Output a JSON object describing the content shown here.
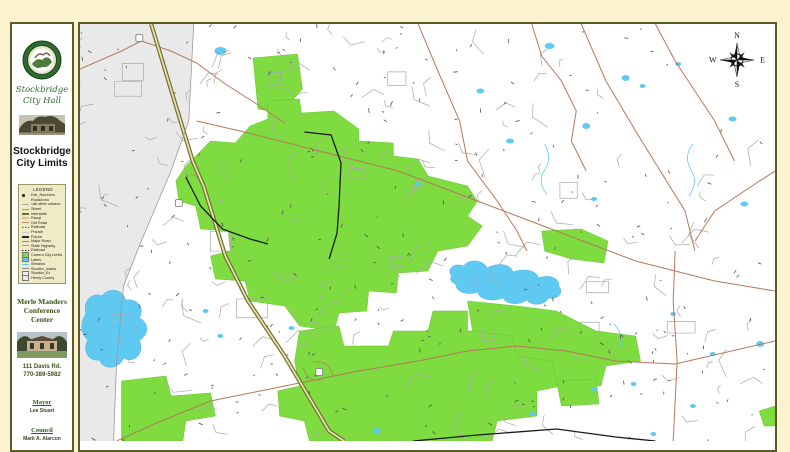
{
  "sidebar": {
    "hall_title": [
      "Stockbridge",
      "City Hall"
    ],
    "map_title": [
      "Stockbridge",
      "City Limits"
    ],
    "legend": {
      "title": "LEGEND",
      "items": [
        {
          "label": "Exit_Numbers",
          "sym": "dot",
          "color": "#222222"
        },
        {
          "label": "RoadAnno",
          "sym": "none",
          "color": "#666666"
        },
        {
          "label": "<all other values>",
          "sym": "line",
          "color": "#aaaaaa"
        },
        {
          "label": "Street",
          "sym": "line",
          "color": "#999999"
        },
        {
          "label": "Interstate",
          "sym": "thick",
          "color": "#6F6F2A"
        },
        {
          "label": "Ramp",
          "sym": "thick",
          "color": "#C9C99A"
        },
        {
          "label": "Old Road",
          "sym": "line",
          "color": "#B89070"
        },
        {
          "label": "Railroad",
          "sym": "dash",
          "color": "#555555"
        },
        {
          "label": "Private",
          "sym": "line",
          "color": "#C9C9C9"
        },
        {
          "label": "Future",
          "sym": "thick",
          "color": "#222222"
        },
        {
          "label": "Major Road",
          "sym": "line",
          "color": "#B5785A"
        },
        {
          "label": "State Highway",
          "sym": "line",
          "color": "#C08C6C"
        },
        {
          "label": "Railroad",
          "sym": "dash",
          "color": "#333333"
        },
        {
          "label": "Current City Limits",
          "sym": "swatch",
          "color": "#7EDC41"
        },
        {
          "label": "Lakes",
          "sym": "swatch",
          "color": "#5FC9F2"
        },
        {
          "label": "Streams",
          "sym": "line",
          "color": "#5FC9F2"
        },
        {
          "label": "Stockbr_marks",
          "sym": "line",
          "color": "#8888AA"
        },
        {
          "label": "Stockbr_Ex",
          "sym": "swatch",
          "color": "#EFEFEF"
        },
        {
          "label": "Henry County",
          "sym": "swatch",
          "color": "#E9E9E9"
        }
      ]
    },
    "venue": {
      "name": [
        "Merle Manders",
        "Conference Center"
      ],
      "address": "111 Davis Rd.",
      "phone": "770-389-5982"
    },
    "officials": [
      {
        "role": "Mayor",
        "name": "Lee Stuart"
      },
      {
        "role": "Council",
        "name": "Mark A. Alarcon"
      }
    ]
  },
  "compass": {
    "north": "N",
    "east": "E",
    "south": "S",
    "west": "W"
  },
  "map": {
    "colors": {
      "page_bg": "#FBF2D0",
      "frame": "#5B5B26",
      "county_fill": "#E9E9E9",
      "city_green": "#7EDC41",
      "water": "#5FC9F2",
      "road_minor": "#A8A8A8",
      "road_tick": "#4F4F4F",
      "road_major": "#B5785A",
      "interstate_casing": "#6F6F2A",
      "interstate_fill": "#E6E2B4",
      "railroad": "#1A1A1A",
      "boundary": "#999999"
    },
    "layers": {
      "county": "M0,0 L115,0 L110,97 L92,147 L62,217 L44,262 L37,337 L34,417 L0,417 Z",
      "boundary": "M115,0 L110,97 L92,147 L62,217 L44,262 L37,337 L34,417",
      "city_polygons": [
        "M175,34 L220,30 L225,65 L204,89 L180,85 Z",
        "M107,142 L132,117 L157,119 L172,102 L190,95 L190,77 L222,75 L224,89 L257,87 L282,105 L282,117 L317,119 L317,132 L342,135 L352,152 L392,162 L402,177 L392,192 L407,202 L392,222 L362,227 L352,247 L322,249 L320,269 L292,267 L290,287 L262,289 L257,307 L222,302 L207,282 L172,277 L167,257 L137,255 L132,232 L152,227 L150,207 L122,205 L117,182 L100,177 L97,157 Z",
        "M222,307 L262,302 L267,322 L312,322 L317,307 L352,307 L357,287 L392,287 L392,307 L442,307 L452,327 L482,332 L487,362 L462,367 L462,392 L422,397 L417,417 L232,417 L227,397 L202,392 L200,367 L222,362 L217,337 Z",
        "M392,277 L442,282 L482,287 L522,307 L562,312 L567,337 L532,342 L527,362 L482,357 L477,337 L442,332 L437,312 L397,307 Z",
        "M467,207 L507,205 L534,217 L530,239 L497,235 L470,227 Z",
        "M42,357 L87,352 L92,372 L132,369 L137,392 L107,397 L104,417 L42,417 Z",
        "M687,387 L703,382 L703,402 L692,402 Z",
        "M482,357 L522,355 L525,380 L487,382 Z"
      ],
      "lakes": [
        "M6,290 C2,275 14,268 22,272 C30,262 44,266 46,276 C58,274 66,284 60,294 C70,298 70,312 60,316 C66,330 54,340 44,334 C40,346 22,346 20,336 C8,338 2,326 8,316 C0,310 0,298 6,290 Z",
        "M376,252 C370,246 378,238 388,242 C394,234 408,236 412,244 C422,238 436,240 438,248 C448,244 462,246 464,254 C474,250 486,254 484,262 C490,268 484,276 474,274 C470,282 456,282 452,276 C444,282 430,280 428,274 C418,278 404,276 402,268 C392,272 380,268 380,260 C374,258 374,254 376,252 Z"
      ],
      "ponds": [
        [
          142,
          27,
          6,
          4
        ],
        [
          405,
          67,
          4,
          2.5
        ],
        [
          435,
          117,
          4,
          2.5
        ],
        [
          475,
          22,
          5,
          3
        ],
        [
          552,
          54,
          4,
          3
        ],
        [
          569,
          62,
          3,
          2
        ],
        [
          512,
          102,
          4,
          3
        ],
        [
          605,
          40,
          3,
          2
        ],
        [
          660,
          95,
          4,
          2.5
        ],
        [
          342,
          160,
          3,
          2
        ],
        [
          300,
          407,
          4,
          3
        ],
        [
          127,
          287,
          3,
          2
        ],
        [
          142,
          312,
          3,
          2
        ],
        [
          214,
          304,
          3,
          2
        ],
        [
          688,
          320,
          4,
          3
        ],
        [
          640,
          330,
          3,
          2
        ],
        [
          600,
          290,
          3,
          2
        ],
        [
          560,
          360,
          3,
          2
        ],
        [
          520,
          365,
          3,
          2
        ],
        [
          620,
          382,
          3,
          2
        ],
        [
          580,
          410,
          3,
          2
        ],
        [
          458,
          390,
          3,
          2
        ],
        [
          672,
          180,
          4,
          2.5
        ],
        [
          520,
          175,
          3,
          2
        ]
      ],
      "streams": [
        "M470,120 q8,14 0,26 q-8,12 2,24",
        "M620,120 q-10,12 -2,26 q8,12 -2,26",
        "M540,300 q10,10 6,24"
      ],
      "roads_major": [
        "M0,45 L42,27 L62,17 L92,27 L118,39 L147,60 L174,77 L207,99",
        "M342,0 L362,47 L384,97 L392,137 L422,177 L442,207 L452,227",
        "M507,0 L532,57 L562,107 L587,147 L612,187 L622,227",
        "M582,0 L602,37 L622,67 L642,97 L662,137",
        "M602,227 L600,277 L604,337 L600,417",
        "M37,417 L82,397 L132,377 L182,367 L232,357 L282,347 L342,337 L392,327 L442,322 L492,327 L542,337 L602,340 L703,317",
        "M118,97 L162,107 L202,117 L242,127 L282,137 L322,147 L362,162 L402,177 L442,192 L482,207 L522,222 L562,237 L602,247 L642,257 L703,267",
        "M457,0 L467,32 L487,57 L502,87 L497,117 L512,147",
        "M703,147 L672,167 L642,187 L622,217"
      ],
      "interstate": "M72,0 L94,72 L114,137 L125,162 L147,232 L170,277 L207,332 L252,407 L267,417",
      "interstate_ramps": [
        "M112,150 q14,4 16,20",
        "M236,338 q16,-2 20,14",
        "M244,356 q-14,2 -18,-12"
      ],
      "railroads": [
        "M227,108 L254,111 L264,139 L262,182 L260,209 L252,235",
        "M107,153 L122,182 L144,205 L172,215 L190,220",
        "M337,417 L402,411 L482,405 L542,413 L582,417"
      ],
      "shields": [
        [
          60,
          14
        ],
        [
          100,
          179
        ],
        [
          242,
          348
        ]
      ]
    }
  }
}
